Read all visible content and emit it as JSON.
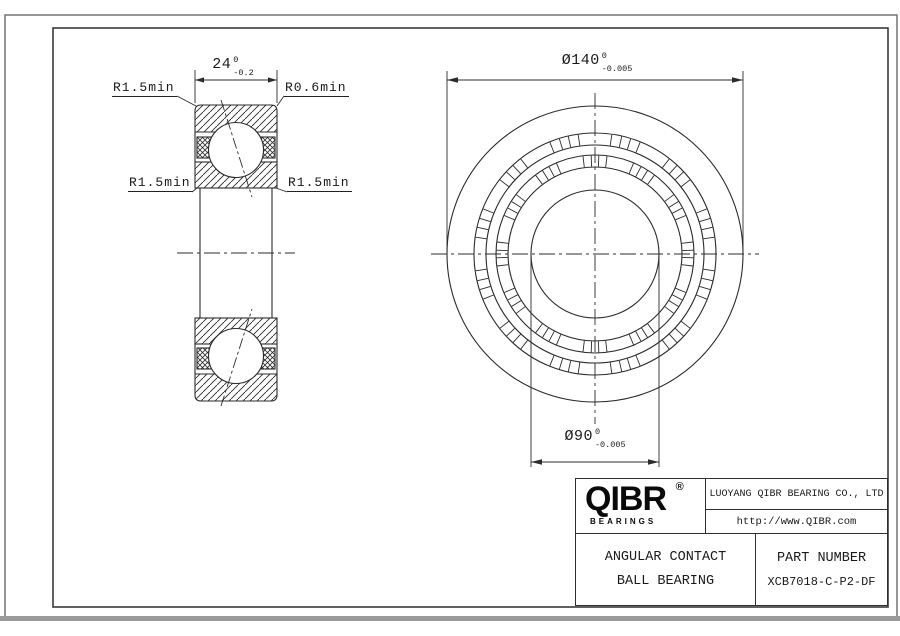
{
  "section": {
    "dim_width": {
      "value": "24",
      "tol_upper": "0",
      "tol_lower": "-0.2"
    },
    "labels": {
      "top_left": "R1.5min",
      "top_right": "R0.6min",
      "mid_left": "R1.5min",
      "mid_right": "R1.5min"
    }
  },
  "front": {
    "dim_od": {
      "value": "Ø140",
      "tol_upper": "0",
      "tol_lower": "-0.005"
    },
    "dim_bore": {
      "value": "Ø90",
      "tol_upper": "0",
      "tol_lower": "-0.005"
    }
  },
  "title_block": {
    "logo_text": "QIBR",
    "registered_mark": "®",
    "logo_subtitle": "BEARINGS",
    "company": "LUOYANG QIBR BEARING CO., LTD",
    "website": "http://www.QIBR.com",
    "product_line1": "ANGULAR CONTACT",
    "product_line2": "BALL BEARING",
    "part_number_label": "PART NUMBER",
    "part_number": "XCB7018-C-P2-DF"
  },
  "colors": {
    "line": "#2b2b2b",
    "frame": "#6a6a6a",
    "bottom_bar": "#9a9a9a"
  }
}
